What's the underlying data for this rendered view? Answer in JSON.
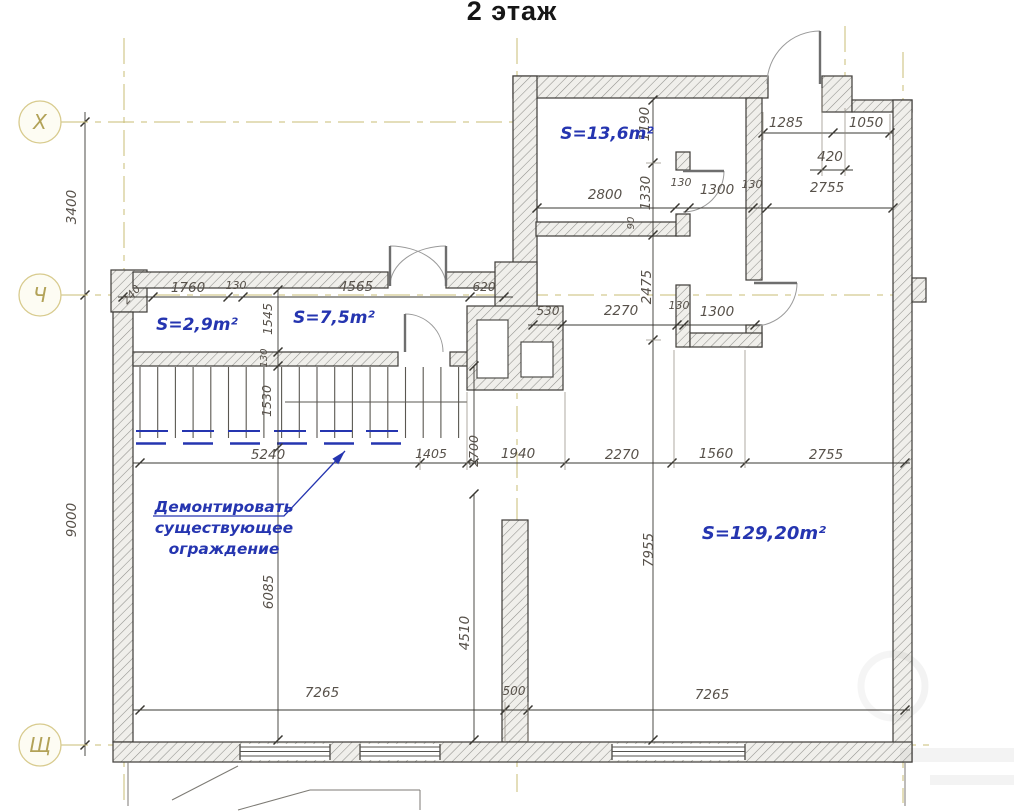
{
  "title": "2 этаж",
  "axis_bubbles": [
    {
      "label": "Х",
      "x": 40,
      "y": 122
    },
    {
      "label": "Ч",
      "x": 40,
      "y": 295
    },
    {
      "label": "Щ",
      "x": 40,
      "y": 745
    }
  ],
  "rooms": [
    {
      "label": "S=13,6m²",
      "x": 607,
      "y": 139,
      "size": 17
    },
    {
      "label": "S=2,9m²",
      "x": 197,
      "y": 330,
      "size": 17
    },
    {
      "label": "S=7,5m²",
      "x": 334,
      "y": 323,
      "size": 17
    },
    {
      "label": "S=129,20m²",
      "x": 764,
      "y": 539,
      "size": 18
    }
  ],
  "annotation": {
    "lines": [
      "Демонтировать",
      "существующее",
      "ограждение"
    ],
    "x": 224,
    "line_ys": [
      512,
      533,
      554
    ]
  },
  "dimensions": [
    {
      "t": "1285",
      "x": 786,
      "y": 127
    },
    {
      "t": "1050",
      "x": 866,
      "y": 127
    },
    {
      "t": "420",
      "x": 830,
      "y": 161
    },
    {
      "t": "2800",
      "x": 605,
      "y": 199
    },
    {
      "t": "130",
      "x": 681,
      "y": 186,
      "s": 11
    },
    {
      "t": "1300",
      "x": 717,
      "y": 194
    },
    {
      "t": "130",
      "x": 752,
      "y": 188,
      "s": 11
    },
    {
      "t": "2755",
      "x": 827,
      "y": 192
    },
    {
      "t": "240",
      "x": 134,
      "y": 297,
      "r": -48,
      "s": 11
    },
    {
      "t": "1760",
      "x": 188,
      "y": 292
    },
    {
      "t": "130",
      "x": 236,
      "y": 289,
      "s": 11
    },
    {
      "t": "4565",
      "x": 356,
      "y": 291
    },
    {
      "t": "620",
      "x": 484,
      "y": 291,
      "s": 12
    },
    {
      "t": "530",
      "x": 548,
      "y": 315,
      "s": 12
    },
    {
      "t": "2270",
      "x": 621,
      "y": 315
    },
    {
      "t": "130",
      "x": 679,
      "y": 309,
      "s": 11
    },
    {
      "t": "1300",
      "x": 717,
      "y": 316
    },
    {
      "t": "5240",
      "x": 268,
      "y": 459
    },
    {
      "t": "1405",
      "x": 431,
      "y": 458,
      "s": 12.5
    },
    {
      "t": "1940",
      "x": 518,
      "y": 458
    },
    {
      "t": "2270",
      "x": 622,
      "y": 459
    },
    {
      "t": "1560",
      "x": 716,
      "y": 458
    },
    {
      "t": "2755",
      "x": 826,
      "y": 459
    },
    {
      "t": "7265",
      "x": 322,
      "y": 697
    },
    {
      "t": "500",
      "x": 514,
      "y": 695,
      "s": 12
    },
    {
      "t": "7265",
      "x": 712,
      "y": 699
    },
    {
      "t": "3400",
      "x": 76,
      "y": 207,
      "r": -90
    },
    {
      "t": "9000",
      "x": 76,
      "y": 520,
      "r": -90
    },
    {
      "t": "1190",
      "x": 649,
      "y": 124,
      "r": -90
    },
    {
      "t": "1330",
      "x": 650,
      "y": 193,
      "r": -90
    },
    {
      "t": "2475",
      "x": 651,
      "y": 287,
      "r": -90
    },
    {
      "t": "7955",
      "x": 653,
      "y": 550,
      "r": -90
    },
    {
      "t": "2700",
      "x": 478,
      "y": 451,
      "r": -90,
      "s": 12.5
    },
    {
      "t": "1545",
      "x": 272,
      "y": 319,
      "r": -90,
      "s": 12.5
    },
    {
      "t": "130",
      "x": 267,
      "y": 358,
      "r": -90,
      "s": 10
    },
    {
      "t": "1530",
      "x": 271,
      "y": 401,
      "r": -90,
      "s": 12.5
    },
    {
      "t": "6085",
      "x": 273,
      "y": 592,
      "r": -90
    },
    {
      "t": "4510",
      "x": 469,
      "y": 633,
      "r": -90
    },
    {
      "t": "90",
      "x": 634,
      "y": 223,
      "r": -90,
      "s": 10
    }
  ],
  "colors": {
    "blue": "#2535b0",
    "axis_line": "#c9bd76",
    "axis_text": "#b2a258",
    "axis_fill": "#fdfcf3",
    "dim_text": "#57514a",
    "line": "#3a3833",
    "wall_stroke": "#43423e"
  }
}
